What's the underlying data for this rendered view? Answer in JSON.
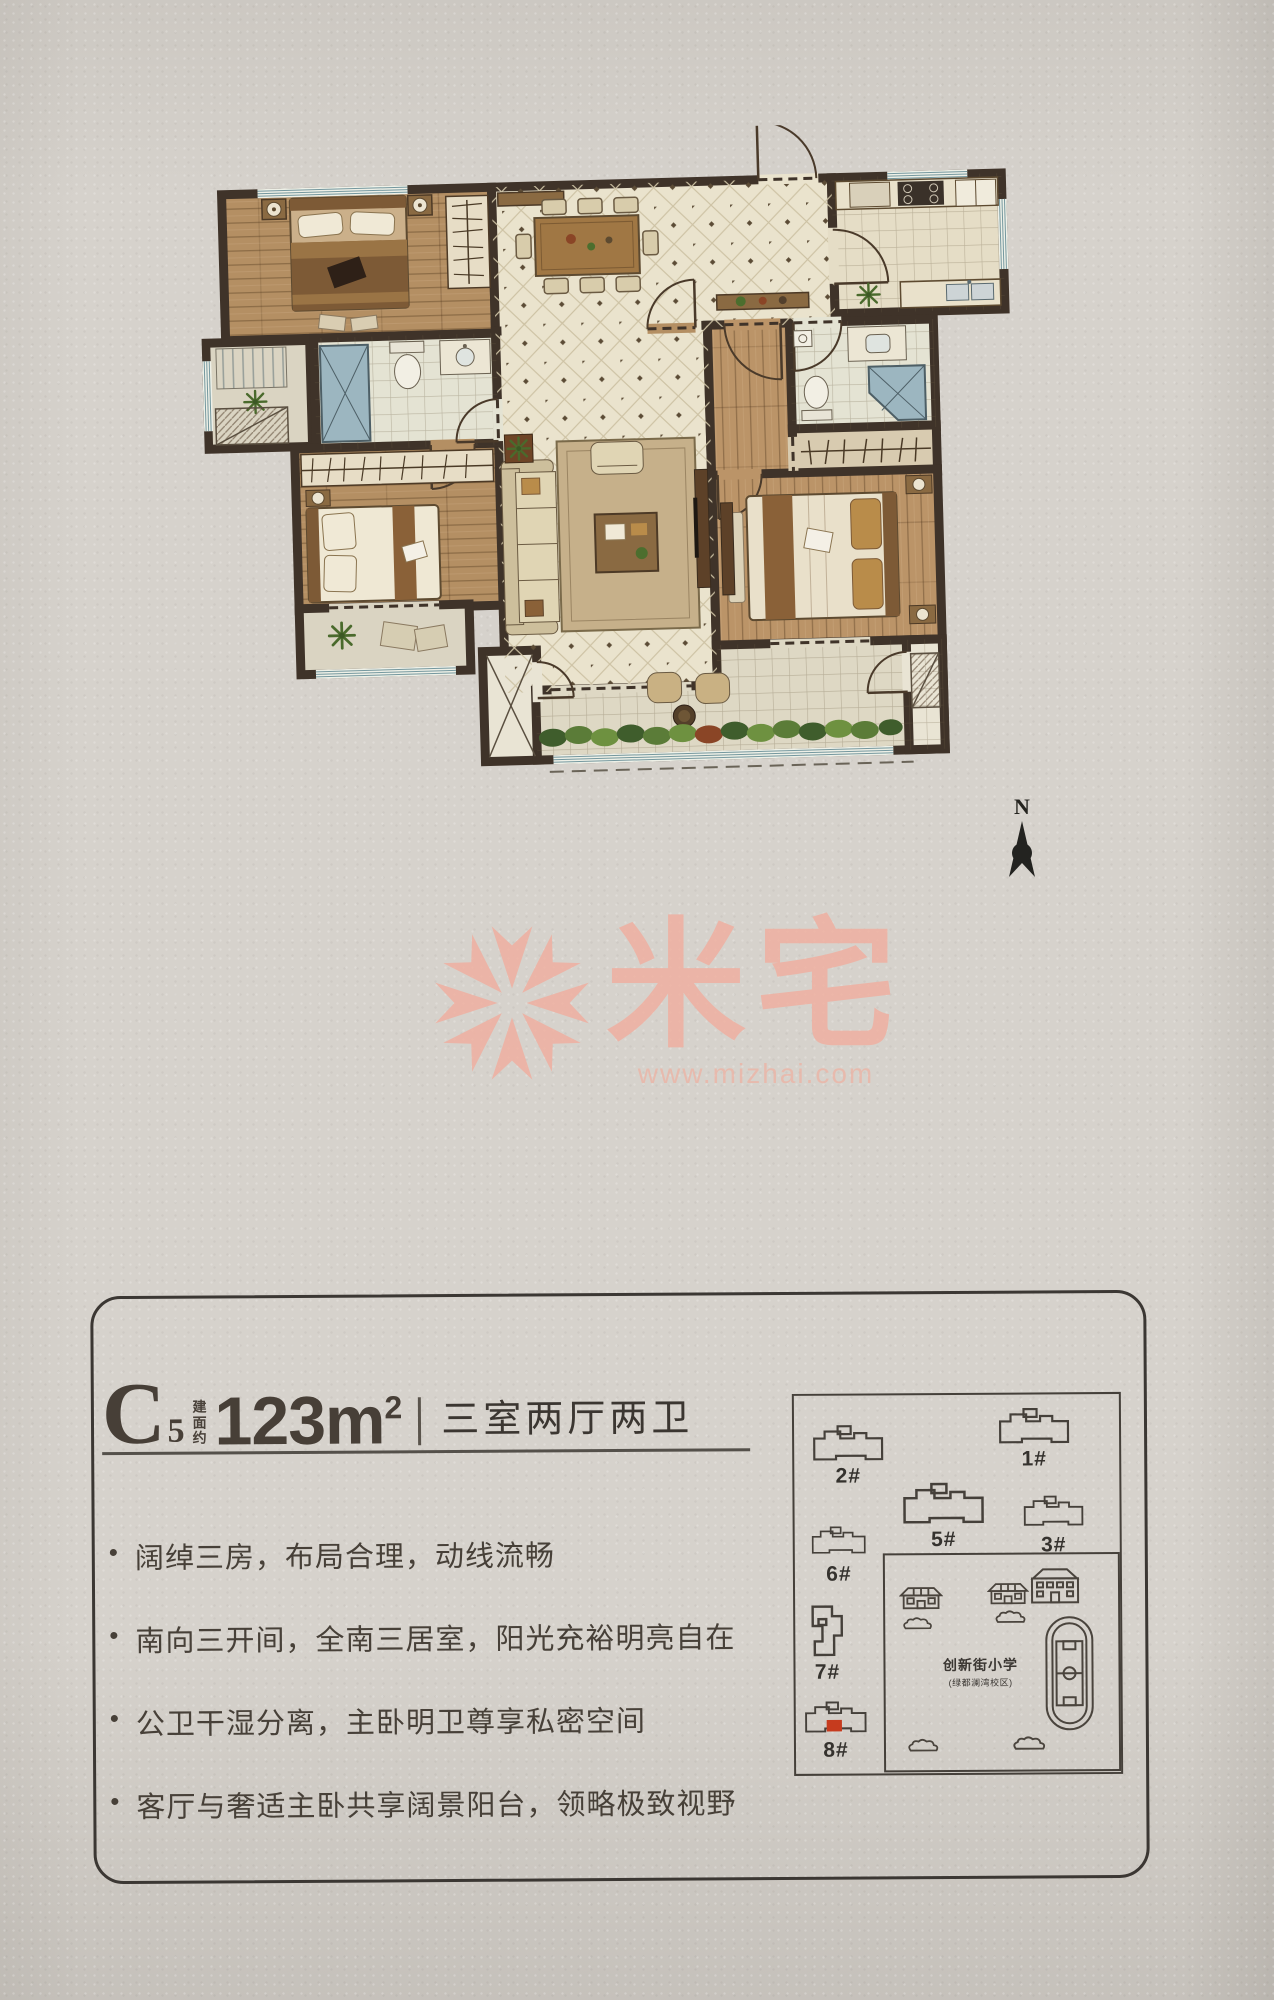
{
  "page": {
    "bg_color": "#d6d2cc"
  },
  "compass": {
    "label": "N"
  },
  "watermark": {
    "brand": "米宅",
    "url": "www.mizhai.com",
    "color": "#efb1a2"
  },
  "floor_plan": {
    "wall_color": "#3f3329",
    "tile_color": "#eae3cd",
    "wood_color": "#b48f63",
    "bath_color": "#e4e3d3",
    "shower_color": "#9cb6c0",
    "plant_color": "#4a6a2c",
    "balcony_color": "#ded8c4"
  },
  "info_card": {
    "unit_letter": "C",
    "unit_number": "5",
    "area_label": "建面约",
    "area_value": "123m",
    "area_exponent": "2",
    "layout_text": "三室两厅两卫",
    "features": [
      "阔绰三房，布局合理，动线流畅",
      "南向三开间，全南三居室，阳光充裕明亮自在",
      "公卫干湿分离，主卧明卫尊享私密空间",
      "客厅与奢适主卧共享阔景阳台，领略极致视野"
    ]
  },
  "site_plan": {
    "buildings": [
      {
        "label": "2#"
      },
      {
        "label": "1#"
      },
      {
        "label": "5#"
      },
      {
        "label": "3#"
      },
      {
        "label": "6#"
      },
      {
        "label": "7#"
      },
      {
        "label": "8#",
        "highlighted": true
      }
    ],
    "highlight_color": "#c63b1e",
    "school": {
      "name": "创新街小学",
      "subtitle": "(绿都澜湾校区)"
    }
  }
}
